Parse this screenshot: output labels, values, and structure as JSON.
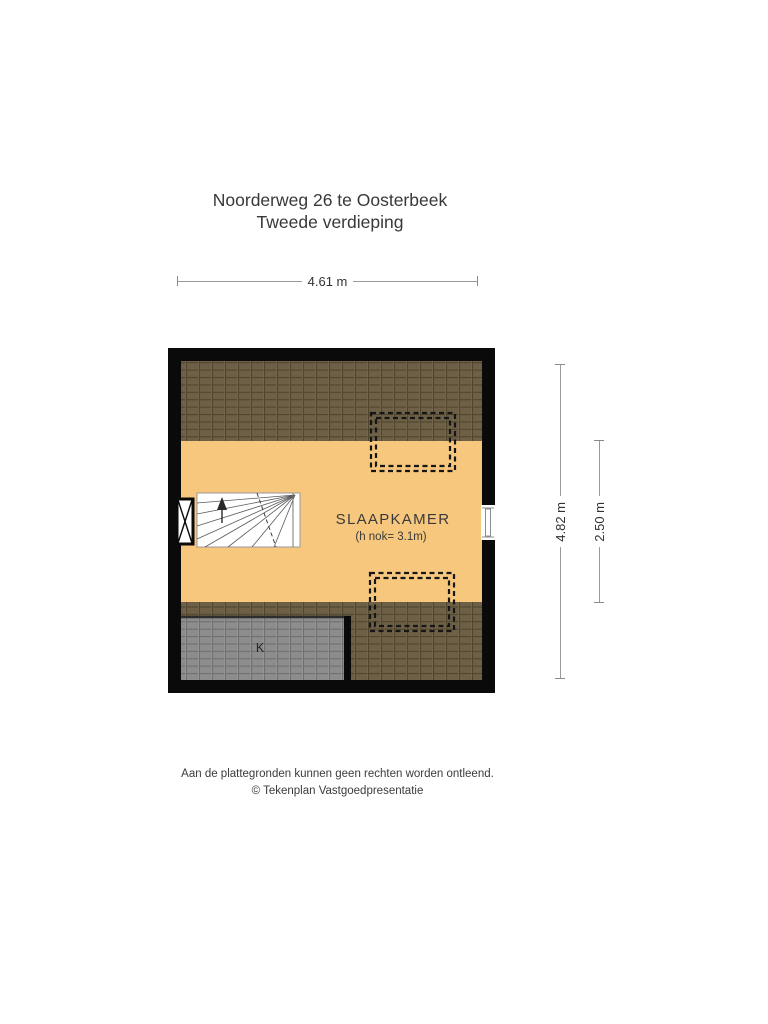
{
  "title": {
    "line1": "Noorderweg 26 te Oosterbeek",
    "line2": "Tweede verdieping"
  },
  "dimensions": {
    "top_width": "4.61 m",
    "right_height": "4.82 m",
    "right_inner_height": "2.50 m"
  },
  "rooms": {
    "bedroom": {
      "label": "SLAAPKAMER",
      "sublabel": "(h nok= 3.1m)"
    },
    "closet": {
      "label": "K"
    }
  },
  "footer": {
    "disclaimer": "Aan de plattegronden kunnen geen rechten worden ontleend.",
    "copyright": "© Tekenplan Vastgoedpresentatie"
  },
  "colors": {
    "wall": "#0a0a0a",
    "floor": "#f6c77d",
    "roof_tile": "#6d6047",
    "roof_tile_line": "#51462d",
    "closet_tile": "#8d8d8d",
    "closet_tile_line": "#707070",
    "dashed_outline": "#161616",
    "dimension_line": "#9a9a9a",
    "text": "#3b3b3b"
  }
}
